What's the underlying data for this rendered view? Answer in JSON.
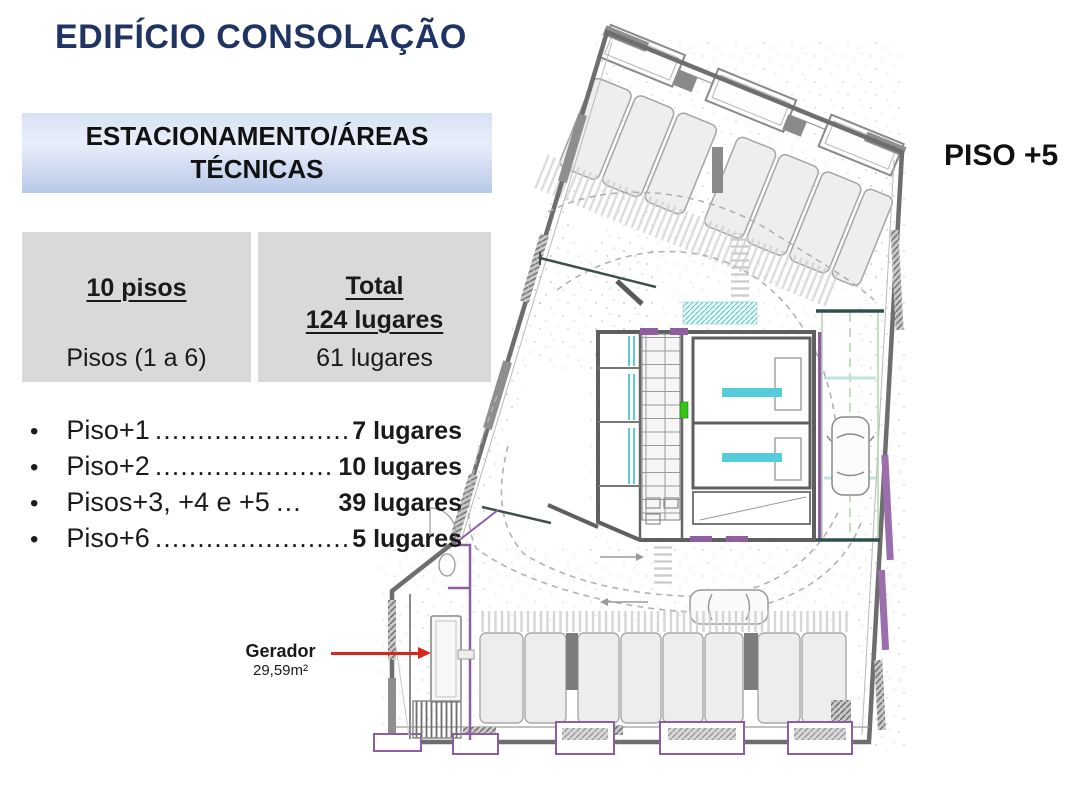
{
  "title": "EDIFÍCIO CONSOLAÇÃO",
  "header_box": {
    "line1": "ESTACIONAMENTO/ÁREAS",
    "line2": "TÉCNICAS"
  },
  "summary": {
    "left": {
      "heading": "10 pisos",
      "row": "Pisos (1 a 6)"
    },
    "right": {
      "heading_line1": "Total",
      "heading_line2": "124 lugares",
      "row": "61 lugares"
    }
  },
  "bullets": [
    {
      "label": "Piso+1",
      "leader": "..............................",
      "value": "7 lugares"
    },
    {
      "label": "Piso+2",
      "leader": "..............................",
      "value": "10 lugares"
    },
    {
      "label": "Pisos+3, +4 e +5",
      "leader": "…",
      "value": "39 lugares"
    },
    {
      "label": "Piso+6",
      "leader": "................................",
      "value": "5 lugares"
    }
  ],
  "annotation": {
    "label": "Gerador",
    "area": "29,59m²"
  },
  "floor_label": "PISO +5",
  "colors": {
    "title_navy": "#1f3462",
    "header_gradient_top": "#d7e1f3",
    "header_gradient_bottom": "#b7c8e8",
    "panel_gray": "#d9d9d9",
    "arrow_red": "#d9261c",
    "plan_wall_gray": "#6e6e6e",
    "plan_purple": "#8d5fa0",
    "plan_cyan": "#55cdd8",
    "plan_green": "#35c519",
    "plan_teal_dark": "#3d504d"
  }
}
